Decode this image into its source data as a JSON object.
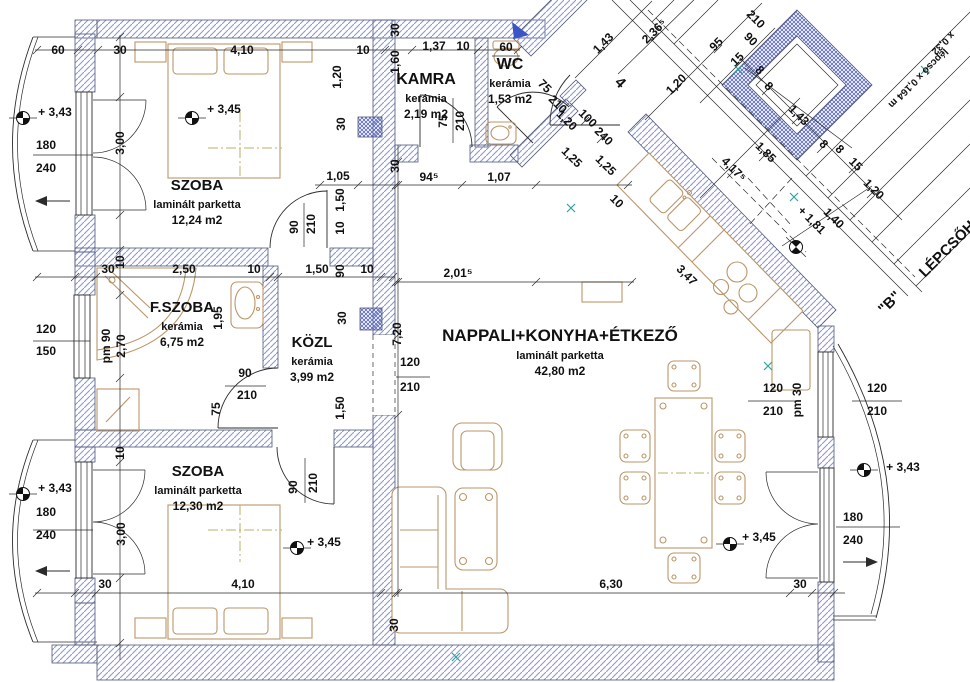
{
  "colors": {
    "wall_hatch": "#8d97d8",
    "wall_edge": "#4f5878",
    "line": "#2b2b2b",
    "furniture": "#bb9668",
    "centerline": "#b9b26b",
    "accent_blue": "#3b55c4",
    "marker_teal": "#2fa3a0",
    "text": "#111111",
    "paper": "#ffffff"
  },
  "rooms": [
    {
      "name": "SZOBA",
      "floor": "laminált parketta",
      "area": "12,24 m2",
      "x": 197,
      "y": 190,
      "ts": 15
    },
    {
      "name": "KAMRA",
      "floor": "kerámia",
      "area": "2,19 m2",
      "x": 426,
      "y": 84,
      "ts": 16
    },
    {
      "name": "WC",
      "floor": "kerámia",
      "area": "1,53 m2",
      "x": 510,
      "y": 69,
      "ts": 16
    },
    {
      "name": "F.SZOBA",
      "floor": "kerámia",
      "area": "6,75 m2",
      "x": 182,
      "y": 312,
      "ts": 15
    },
    {
      "name": "KÖZL",
      "floor": "kerámia",
      "area": "3,99 m2",
      "x": 312,
      "y": 347,
      "ts": 15
    },
    {
      "name": "NAPPALI+KONYHA+ÉTKEZŐ",
      "floor": "laminált parketta",
      "area": "42,80 m2",
      "x": 560,
      "y": 341,
      "ts": 17
    },
    {
      "name": "SZOBA",
      "floor": "laminált parketta",
      "area": "12,30 m2",
      "x": 198,
      "y": 476,
      "ts": 15
    }
  ],
  "labels": [
    {
      "t": "60",
      "x": 58,
      "y": 54
    },
    {
      "t": "30",
      "x": 120,
      "y": 54
    },
    {
      "t": "4,10",
      "x": 242,
      "y": 54
    },
    {
      "t": "10",
      "x": 363,
      "y": 54
    },
    {
      "t": "1,37",
      "x": 434,
      "y": 50
    },
    {
      "t": "10",
      "x": 463,
      "y": 50
    },
    {
      "t": "60",
      "x": 506,
      "y": 51
    },
    {
      "t": "30",
      "x": 399,
      "y": 30,
      "r": -90
    },
    {
      "t": "1,60",
      "x": 399,
      "y": 62,
      "r": -90
    },
    {
      "t": "1,20",
      "x": 341,
      "y": 77,
      "r": -90
    },
    {
      "t": "30",
      "x": 345,
      "y": 124,
      "r": -90
    },
    {
      "t": "75",
      "x": 447,
      "y": 121,
      "r": -90
    },
    {
      "t": "210",
      "x": 464,
      "y": 121,
      "r": -90
    },
    {
      "t": "30",
      "x": 399,
      "y": 166,
      "r": -90
    },
    {
      "t": "75",
      "x": 542,
      "y": 89,
      "r": 45
    },
    {
      "t": "210",
      "x": 555,
      "y": 107,
      "r": 45
    },
    {
      "t": "1,20",
      "x": 564,
      "y": 123,
      "r": 45
    },
    {
      "t": "100",
      "x": 585,
      "y": 121,
      "r": 45
    },
    {
      "t": "240",
      "x": 601,
      "y": 139,
      "r": 45
    },
    {
      "t": "1,25",
      "x": 569,
      "y": 160,
      "r": 45
    },
    {
      "t": "1,25",
      "x": 603,
      "y": 168,
      "r": 45
    },
    {
      "t": "4",
      "x": 617,
      "y": 86,
      "r": 45,
      "s": 15
    },
    {
      "t": "10",
      "x": 614,
      "y": 204,
      "r": 45
    },
    {
      "t": "3,47",
      "x": 684,
      "y": 278,
      "r": 45
    },
    {
      "t": "1,43",
      "x": 606,
      "y": 46,
      "r": -45
    },
    {
      "t": "2,36⁵",
      "x": 657,
      "y": 34,
      "r": -45
    },
    {
      "t": "1,20",
      "x": 679,
      "y": 87,
      "r": -45
    },
    {
      "t": "95",
      "x": 719,
      "y": 47,
      "r": -45
    },
    {
      "t": "15",
      "x": 740,
      "y": 62,
      "r": -45
    },
    {
      "t": "90",
      "x": 748,
      "y": 42,
      "r": 45
    },
    {
      "t": "210",
      "x": 753,
      "y": 22,
      "r": 45
    },
    {
      "t": "8",
      "x": 757,
      "y": 73,
      "r": 45
    },
    {
      "t": "8",
      "x": 766,
      "y": 89,
      "r": 45
    },
    {
      "t": "1,43",
      "x": 796,
      "y": 118,
      "r": 45
    },
    {
      "t": "8",
      "x": 821,
      "y": 147,
      "r": 45
    },
    {
      "t": "8",
      "x": 837,
      "y": 152,
      "r": 45
    },
    {
      "t": "15",
      "x": 853,
      "y": 167,
      "r": 45
    },
    {
      "t": "1,20",
      "x": 871,
      "y": 192,
      "r": 45
    },
    {
      "t": "1,85",
      "x": 763,
      "y": 155,
      "r": 45
    },
    {
      "t": "4,17⁵",
      "x": 731,
      "y": 172,
      "r": 45
    },
    {
      "t": "+ 1,81",
      "x": 809,
      "y": 223,
      "r": 45
    },
    {
      "t": "1,40",
      "x": 831,
      "y": 221,
      "r": 45
    },
    {
      "t": "\"B\"",
      "x": 893,
      "y": 306,
      "r": -45,
      "s": 15
    },
    {
      "t": "LÉPCSŐHÁZ",
      "x": 925,
      "y": 278,
      "r": -45,
      "s": 15,
      "a": "s"
    },
    {
      "t": "lépcső x 0,164 m",
      "x": 916,
      "y": 76,
      "r": 135,
      "s": 10
    },
    {
      "t": "x 0,32",
      "x": 941,
      "y": 41,
      "r": 135,
      "s": 10
    },
    {
      "t": "1,05",
      "x": 338,
      "y": 180
    },
    {
      "t": "94⁵",
      "x": 429,
      "y": 181
    },
    {
      "t": "1,07",
      "x": 499,
      "y": 181
    },
    {
      "t": "2,01⁵",
      "x": 458,
      "y": 277
    },
    {
      "t": "+ 3,45",
      "x": 224,
      "y": 113
    },
    {
      "t": "3,00",
      "x": 124,
      "y": 143,
      "r": -90
    },
    {
      "t": "90",
      "x": 298,
      "y": 227,
      "r": -90
    },
    {
      "t": "210",
      "x": 315,
      "y": 224,
      "r": -90
    },
    {
      "t": "1,50",
      "x": 344,
      "y": 200,
      "r": -90
    },
    {
      "t": "10",
      "x": 344,
      "y": 228,
      "r": -90
    },
    {
      "t": "+ 3,43",
      "x": 55,
      "y": 116
    },
    {
      "t": "180",
      "x": 46,
      "y": 149
    },
    {
      "t": "240",
      "x": 46,
      "y": 172
    },
    {
      "t": "30",
      "x": 108,
      "y": 273
    },
    {
      "t": "10",
      "x": 124,
      "y": 262,
      "r": -90
    },
    {
      "t": "2,50",
      "x": 184,
      "y": 273
    },
    {
      "t": "10",
      "x": 254,
      "y": 273
    },
    {
      "t": "120",
      "x": 46,
      "y": 333
    },
    {
      "t": "150",
      "x": 46,
      "y": 355
    },
    {
      "t": "pm 90",
      "x": 110,
      "y": 346,
      "r": -90
    },
    {
      "t": "2,70",
      "x": 125,
      "y": 346,
      "r": -90
    },
    {
      "t": "1,95",
      "x": 222,
      "y": 318,
      "r": -90
    },
    {
      "t": "90",
      "x": 245,
      "y": 377
    },
    {
      "t": "210",
      "x": 247,
      "y": 399
    },
    {
      "t": "75",
      "x": 220,
      "y": 409,
      "r": -90
    },
    {
      "t": "1,50",
      "x": 317,
      "y": 273
    },
    {
      "t": "90",
      "x": 344,
      "y": 271,
      "r": -90
    },
    {
      "t": "10",
      "x": 367,
      "y": 273
    },
    {
      "t": "30",
      "x": 346,
      "y": 318,
      "r": -90
    },
    {
      "t": "1,50",
      "x": 344,
      "y": 408,
      "r": -90
    },
    {
      "t": "7,20",
      "x": 401,
      "y": 334,
      "r": -90
    },
    {
      "t": "120",
      "x": 410,
      "y": 366
    },
    {
      "t": "210",
      "x": 410,
      "y": 391
    },
    {
      "t": "6,30",
      "x": 611,
      "y": 588
    },
    {
      "t": "30",
      "x": 800,
      "y": 588
    },
    {
      "t": "30",
      "x": 398,
      "y": 625,
      "r": -90
    },
    {
      "t": "+ 3,45",
      "x": 324,
      "y": 546
    },
    {
      "t": "+ 3,43",
      "x": 55,
      "y": 492
    },
    {
      "t": "180",
      "x": 46,
      "y": 516
    },
    {
      "t": "240",
      "x": 46,
      "y": 539
    },
    {
      "t": "3,00",
      "x": 125,
      "y": 534,
      "r": -90
    },
    {
      "t": "10",
      "x": 124,
      "y": 453,
      "r": -90
    },
    {
      "t": "30",
      "x": 105,
      "y": 588
    },
    {
      "t": "4,10",
      "x": 243,
      "y": 588
    },
    {
      "t": "90",
      "x": 297,
      "y": 487,
      "r": -90
    },
    {
      "t": "210",
      "x": 317,
      "y": 483,
      "r": -90
    },
    {
      "t": "pm 30",
      "x": 801,
      "y": 400,
      "r": -90
    },
    {
      "t": "120",
      "x": 773,
      "y": 392
    },
    {
      "t": "210",
      "x": 773,
      "y": 415
    },
    {
      "t": "120",
      "x": 877,
      "y": 392
    },
    {
      "t": "210",
      "x": 877,
      "y": 415
    },
    {
      "t": "+ 3,43",
      "x": 903,
      "y": 471
    },
    {
      "t": "180",
      "x": 853,
      "y": 521
    },
    {
      "t": "240",
      "x": 853,
      "y": 544
    },
    {
      "t": "+ 3,45",
      "x": 759,
      "y": 541
    }
  ]
}
